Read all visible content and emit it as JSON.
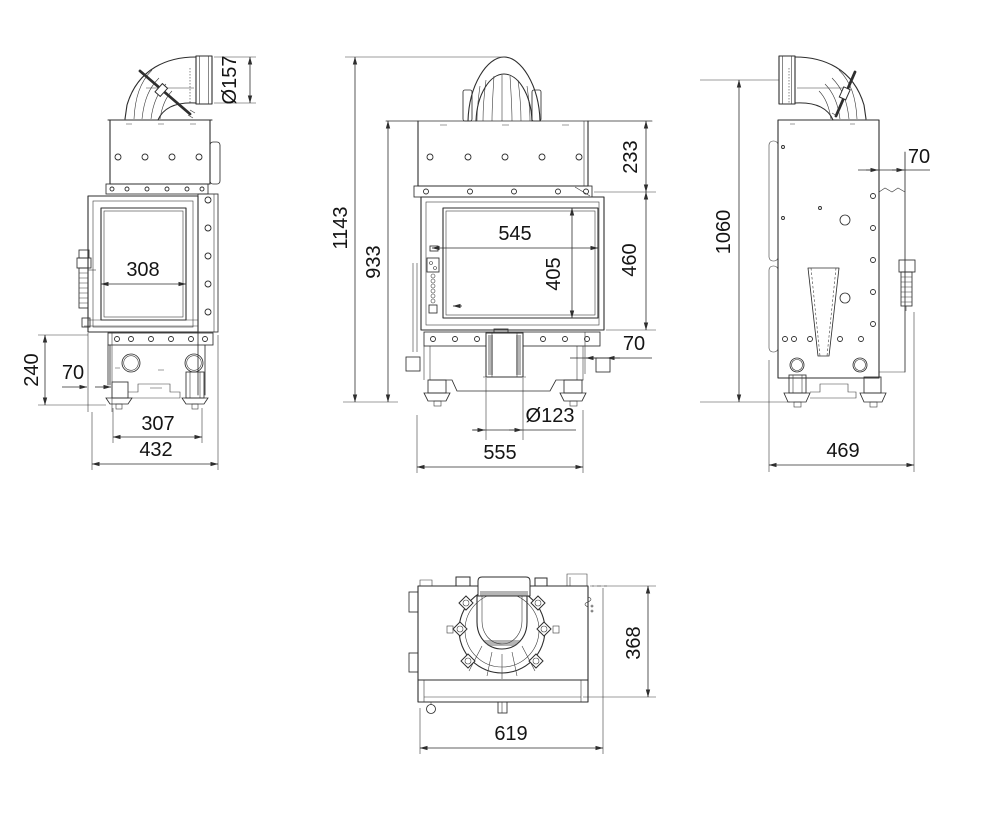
{
  "drawing": {
    "background": "#ffffff",
    "line_color": "#2e2e2e",
    "views": {
      "side_left": {
        "dims": {
          "flue_diameter": "Ø157",
          "glass_width": "308",
          "plinth_height": "240",
          "foot_inset": "70",
          "feet_spacing": "307",
          "overall_depth": "432"
        }
      },
      "front": {
        "dims": {
          "overall_height": "1143",
          "body_height": "933",
          "hood_height": "233",
          "firebox_width": "545",
          "door_height": "460",
          "glass_height": "405",
          "side_offset": "70",
          "air_inlet_diameter": "Ø123",
          "body_width": "555"
        }
      },
      "side_right": {
        "dims": {
          "flue_axis_height": "1060",
          "rear_panel_offset": "70",
          "overall_depth": "469"
        }
      },
      "top": {
        "dims": {
          "overall_depth": "368",
          "overall_width": "619"
        }
      }
    }
  }
}
